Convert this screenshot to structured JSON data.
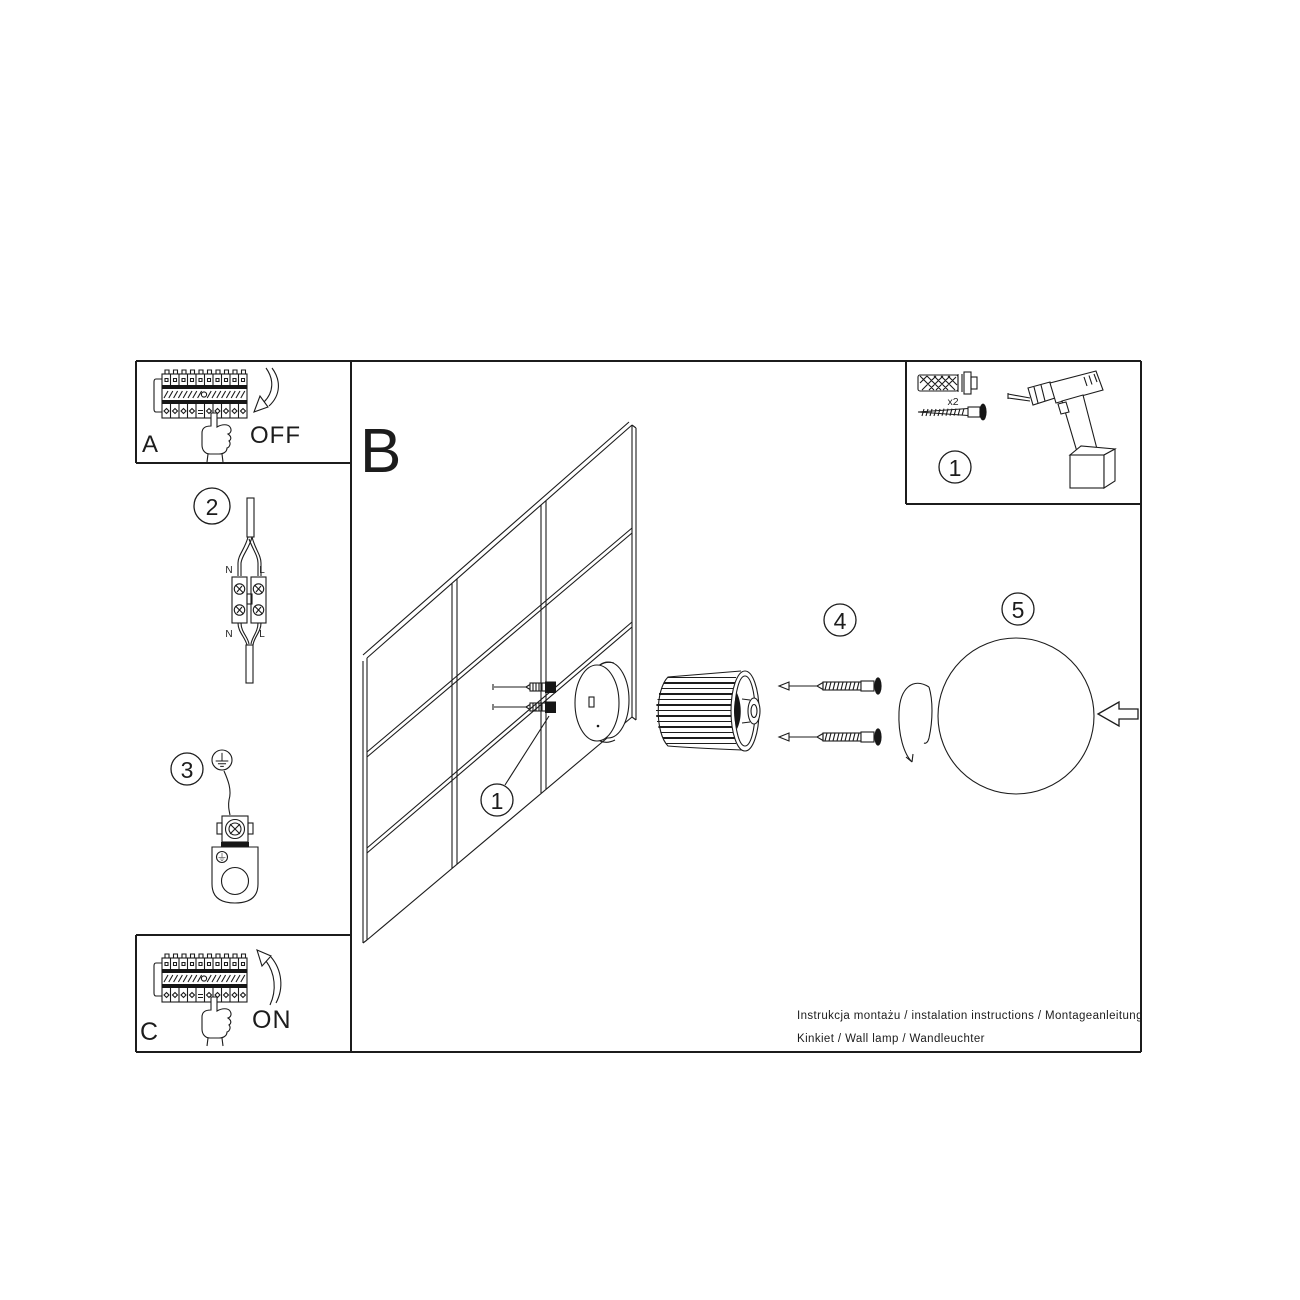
{
  "sheet": {
    "background": "#ffffff",
    "ink": "#1c1c1c"
  },
  "sections": {
    "a": {
      "label": "A",
      "action": "OFF"
    },
    "b": {
      "label": "B"
    },
    "c": {
      "label": "C",
      "action": "ON"
    }
  },
  "step_badges": {
    "wall_anchor": "1",
    "parts": "1",
    "wire_connector": "2",
    "ground_bracket": "3",
    "screws": "4",
    "glass_ball": "5"
  },
  "wire_connector": {
    "n_top": "N",
    "l_top": "L",
    "n_bottom": "N",
    "l_bottom": "L"
  },
  "parts_box": {
    "anchor_quantity": "x2"
  },
  "footer": {
    "line1": "Instrukcja montażu / instalation instructions / Montageanleitung",
    "line2": "Kinkiet / Wall lamp / Wandleuchter"
  }
}
